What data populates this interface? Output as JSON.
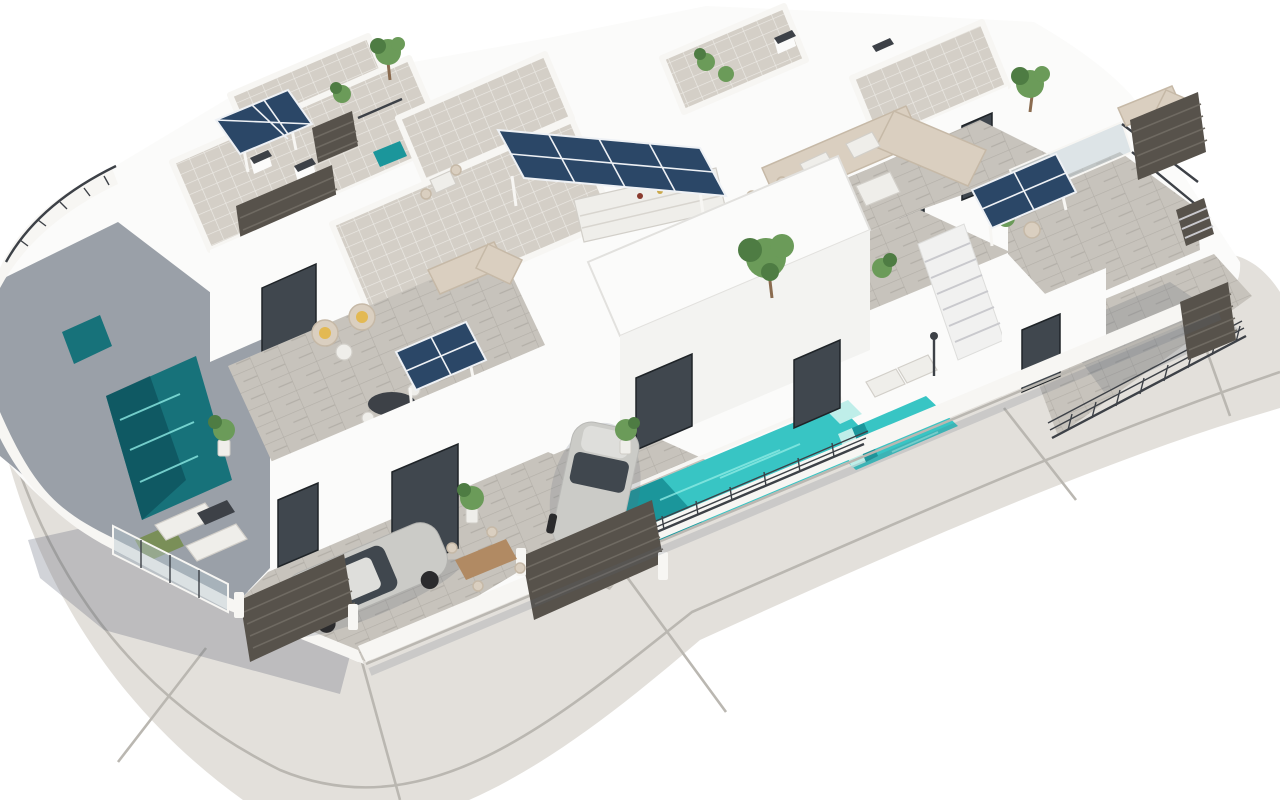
{
  "meta": {
    "type": "3d-architectural-render",
    "description": "Aerial 3D rendering of a modern white Mediterranean villa development: flat-roofed houses with rooftop solar pergolas, tiled roof terraces, private turquoise plunge pools, outdoor lounges, two parked cars and a curved gray road wrapping the corner plot on a white background",
    "visible_text": "none"
  },
  "colors": {
    "background": "#ffffff",
    "road": "#e3e0db",
    "road_joint": "#bab7b1",
    "wall": "#fbfbfa",
    "wall_face": "#f3f3f1",
    "wall_shade": "#e7e7e9",
    "parapet": "#f7f6f3",
    "roof_tile": "#d4cfc7",
    "roof_grout": "#eceae5",
    "paver": "#c7c3bc",
    "paver_line": "#b3afa8",
    "paver_shade": "#9aa0a8",
    "grass": "#7a8f58",
    "pool_bright": "#38c5c4",
    "pool_mid": "#1b969b",
    "pool_dark": "#17727a",
    "pool_deep": "#0e515c",
    "pool_ripple": "#8ceae3",
    "pool_step": "#bfeee9",
    "solar": "#2b4767",
    "solar_dark": "#1e3550",
    "solar_light": "#45658c",
    "solar_frame": "#eef1f5",
    "fence": "#57524b",
    "fence_slat": "#6f6a62",
    "railing": "#3d4147",
    "glass": "#b9c7d0",
    "plant": "#6b9b59",
    "plant_dark": "#4e7c43",
    "trunk": "#8a6b4f",
    "wood": "#b18a63",
    "sofa": "#dacfc0",
    "sofa_shade": "#c6b9a7",
    "cushion": "#e3b953",
    "white_furniture": "#efeeea",
    "car_body": "#cbcbc7",
    "car_roof": "#dededb",
    "car_glass": "#40474e",
    "wheel": "#2b2b2d",
    "step_line": "#c9c9cd",
    "shadow": "#5a6274"
  },
  "objects": {
    "villas": 6,
    "solar_arrays": 4,
    "pools": 3,
    "cars": 2,
    "gates": 2,
    "staircases": 2,
    "sun_loungers": 4,
    "dining_sets": 3,
    "lounge_sofas": 3,
    "plants": 12,
    "labels": [
      "curved perimeter road",
      "white property wall",
      "shaded pool terrace",
      "plunge pool dark",
      "plunge pool center",
      "plunge pool right",
      "solar panel on pole",
      "long solar pergola with outdoor kitchen",
      "solar pergola right",
      "solar pergola left",
      "silver sedan",
      "white hatchback",
      "slatted driveway gates",
      "corner sofa lounge",
      "roof dining set",
      "wicker chairs with yellow cushions",
      "sun loungers",
      "white staircase",
      "metal terrace railings",
      "glass balustrade",
      "outdoor shower",
      "potted plants and trees"
    ]
  }
}
